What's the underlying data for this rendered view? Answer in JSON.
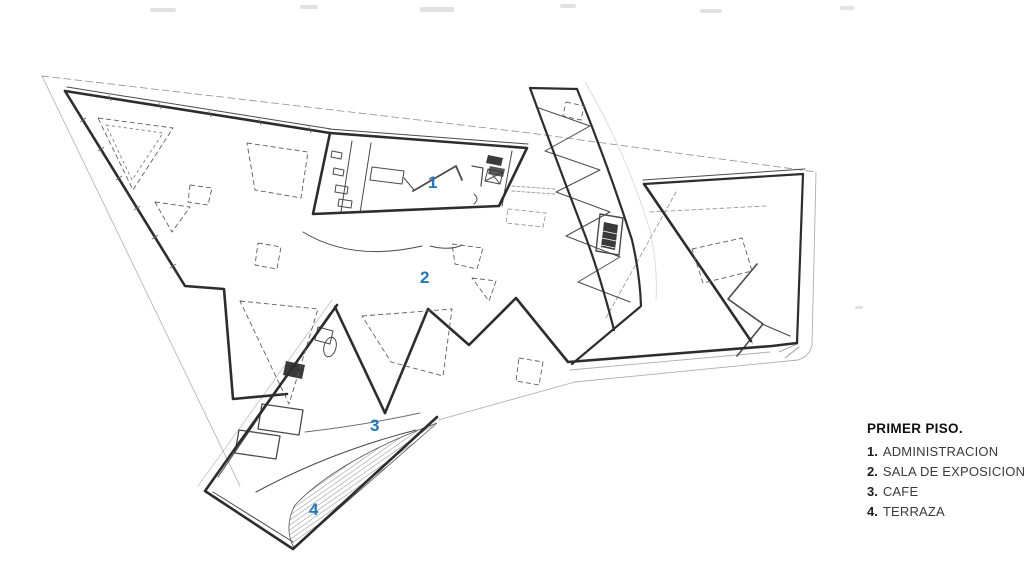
{
  "colors": {
    "accent": "#2577b5",
    "ink": "#2d2d2d"
  },
  "plan_labels": [
    {
      "num": "1"
    },
    {
      "num": "2"
    },
    {
      "num": "3"
    },
    {
      "num": "4"
    }
  ],
  "legend": {
    "title": "PRIMER PISO.",
    "items": [
      {
        "num": "1.",
        "label": "ADMINISTRACION"
      },
      {
        "num": "2.",
        "label": "SALA DE EXPOSICIONES"
      },
      {
        "num": "3.",
        "label": "CAFE"
      },
      {
        "num": "4.",
        "label": "TERRAZA"
      }
    ]
  }
}
